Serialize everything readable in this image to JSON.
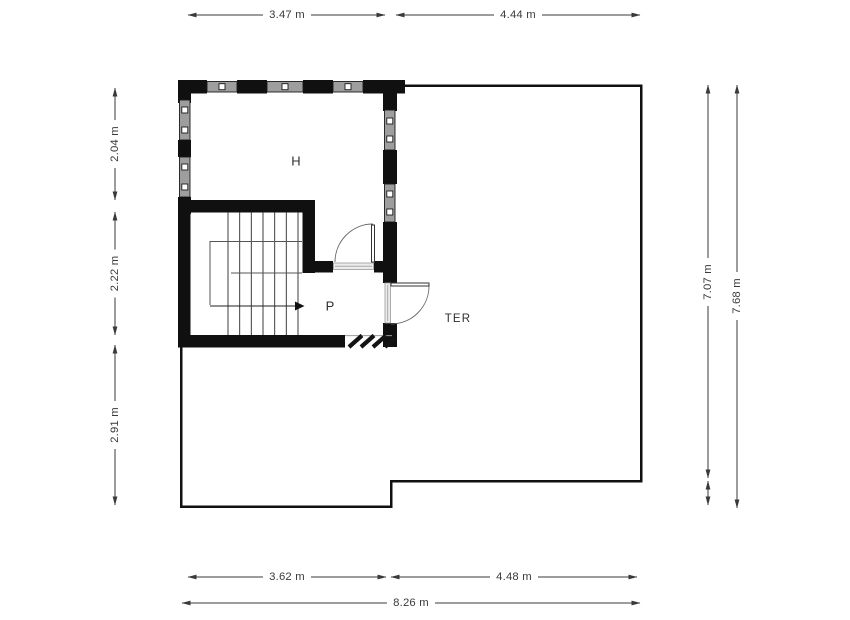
{
  "room_labels": {
    "h": "H",
    "p": "P",
    "ter": "TER"
  },
  "dimensions": {
    "top": [
      "3.47 m",
      "4.44 m"
    ],
    "left": [
      "2.04 m",
      "2.22 m",
      "2.91 m"
    ],
    "right": [
      "7.07 m",
      "7.68 m"
    ],
    "bottom": [
      "3.62 m",
      "4.48 m",
      "8.26 m"
    ]
  },
  "colors": {
    "wall": "#101010",
    "window": "#9e9e9e",
    "dimension": "#3a3a3a",
    "label": "#2e2e2e",
    "background": "#ffffff"
  }
}
